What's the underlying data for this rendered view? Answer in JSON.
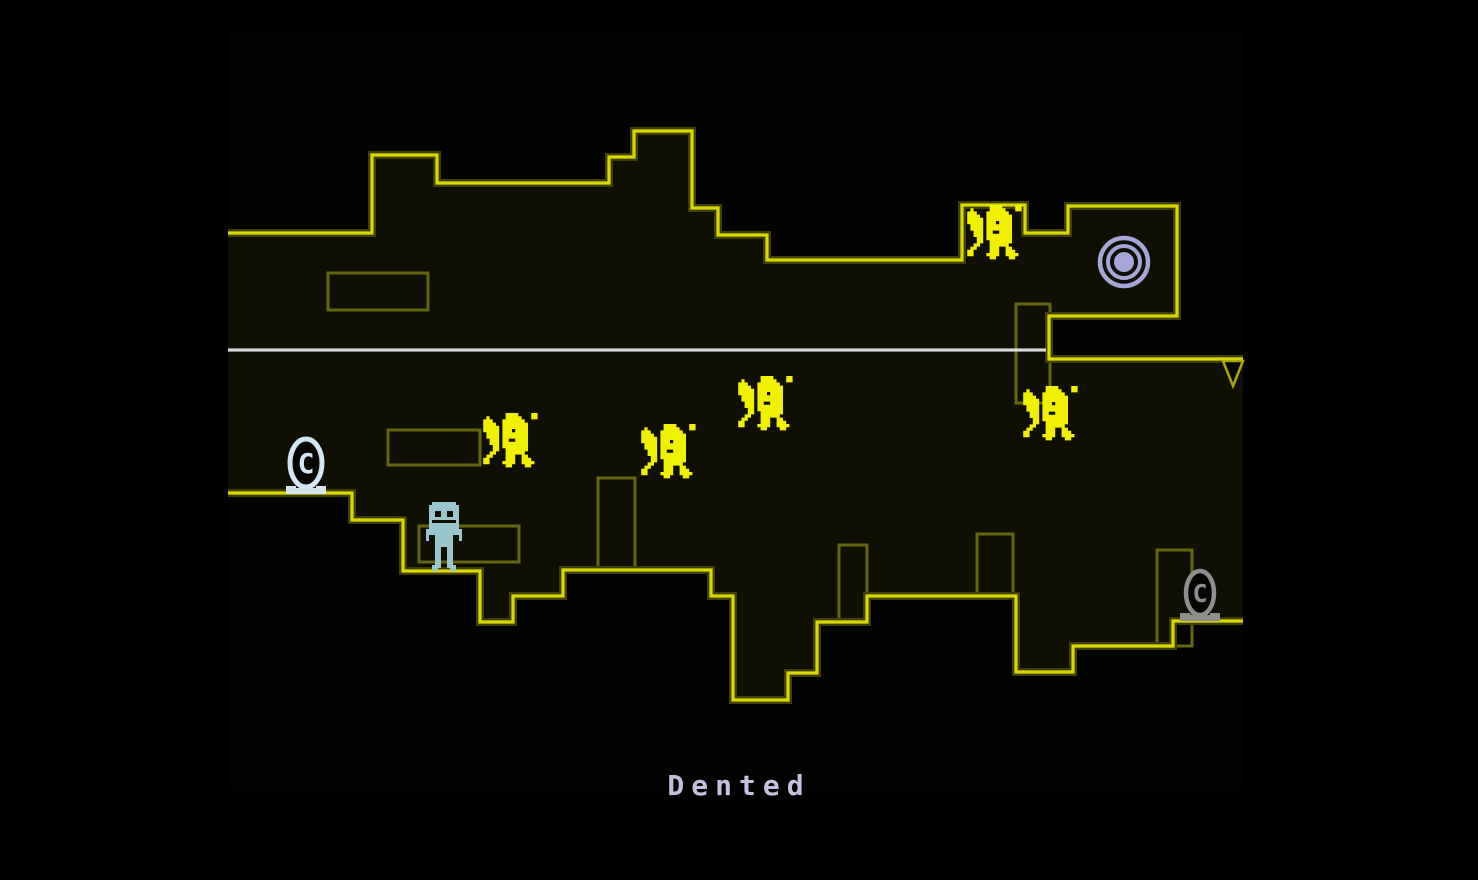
{
  "room": {
    "name": "Dented"
  },
  "viewport": {
    "width": 1478,
    "height": 880,
    "area": {
      "x": 228,
      "y": 30,
      "w": 1015,
      "h": 761
    }
  },
  "colors": {
    "background": "#000000",
    "room_fill": "#020201",
    "space_fill": "#0f0f04",
    "edge_bright": "#d9d900",
    "edge_dim": "#3e3e06",
    "decor_stroke": "#66660e",
    "enemy": "#f0f000",
    "player_body": "#9ac7ce",
    "checkpoint_active": "#d4e5f4",
    "checkpoint_inactive": "#8f8f8f",
    "warp_token": "#a6a6d8",
    "gravity_line": "#d6d6d6",
    "spike_stroke": "#a9a900",
    "spike_fill": "#050502",
    "room_name_text": "#c2c2de"
  },
  "terrain": {
    "top_boundary": [
      [
        228,
        233
      ],
      [
        372,
        233
      ],
      [
        372,
        155
      ],
      [
        437,
        155
      ],
      [
        437,
        183
      ],
      [
        609,
        183
      ],
      [
        609,
        157
      ],
      [
        634,
        157
      ],
      [
        634,
        131
      ],
      [
        692,
        131
      ],
      [
        692,
        208
      ],
      [
        718,
        208
      ],
      [
        718,
        235
      ],
      [
        767,
        235
      ],
      [
        767,
        260
      ],
      [
        962,
        260
      ],
      [
        962,
        205
      ],
      [
        1025,
        205
      ],
      [
        1025,
        233
      ],
      [
        1068,
        233
      ],
      [
        1068,
        206
      ],
      [
        1177,
        206
      ],
      [
        1177,
        316
      ],
      [
        1049,
        316
      ],
      [
        1049,
        359
      ],
      [
        1243,
        359
      ]
    ],
    "bottom_boundary": [
      [
        228,
        493
      ],
      [
        352,
        493
      ],
      [
        352,
        520
      ],
      [
        403,
        520
      ],
      [
        403,
        571
      ],
      [
        480,
        571
      ],
      [
        480,
        622
      ],
      [
        513,
        622
      ],
      [
        513,
        596
      ],
      [
        563,
        596
      ],
      [
        563,
        570
      ],
      [
        711,
        570
      ],
      [
        711,
        596
      ],
      [
        733,
        596
      ],
      [
        733,
        700
      ],
      [
        788,
        700
      ],
      [
        788,
        673
      ],
      [
        817,
        673
      ],
      [
        817,
        622
      ],
      [
        867,
        622
      ],
      [
        867,
        596
      ],
      [
        1016,
        596
      ],
      [
        1016,
        672
      ],
      [
        1073,
        672
      ],
      [
        1073,
        646
      ],
      [
        1173,
        646
      ],
      [
        1173,
        621
      ],
      [
        1243,
        621
      ]
    ],
    "decor_rects": [
      [
        328,
        273,
        100,
        37
      ],
      [
        388,
        430,
        92,
        35
      ],
      [
        419,
        526,
        100,
        36
      ],
      [
        598,
        478,
        37,
        92
      ],
      [
        839,
        545,
        28,
        77
      ],
      [
        977,
        534,
        36,
        62
      ],
      [
        1157,
        550,
        35,
        96
      ],
      [
        1016,
        304,
        34,
        99
      ]
    ]
  },
  "entities": {
    "gravity_line": {
      "x1": 228,
      "y": 350,
      "x2": 1046,
      "thickness": 3.2
    },
    "warp_token": {
      "cx": 1124,
      "cy": 262
    },
    "spike": {
      "points": [
        [
          1223,
          361
        ],
        [
          1243,
          361
        ],
        [
          1233,
          386
        ]
      ]
    },
    "player": {
      "x": 426,
      "y": 502,
      "state": "standing"
    },
    "enemies": [
      {
        "x": 964,
        "y": 205
      },
      {
        "x": 735,
        "y": 376
      },
      {
        "x": 638,
        "y": 424
      },
      {
        "x": 480,
        "y": 413
      },
      {
        "x": 1020,
        "y": 386
      }
    ],
    "checkpoints": [
      {
        "cx": 306,
        "bottom": 494,
        "state": "active"
      },
      {
        "cx": 1200,
        "bottom": 621,
        "state": "inactive"
      }
    ]
  }
}
